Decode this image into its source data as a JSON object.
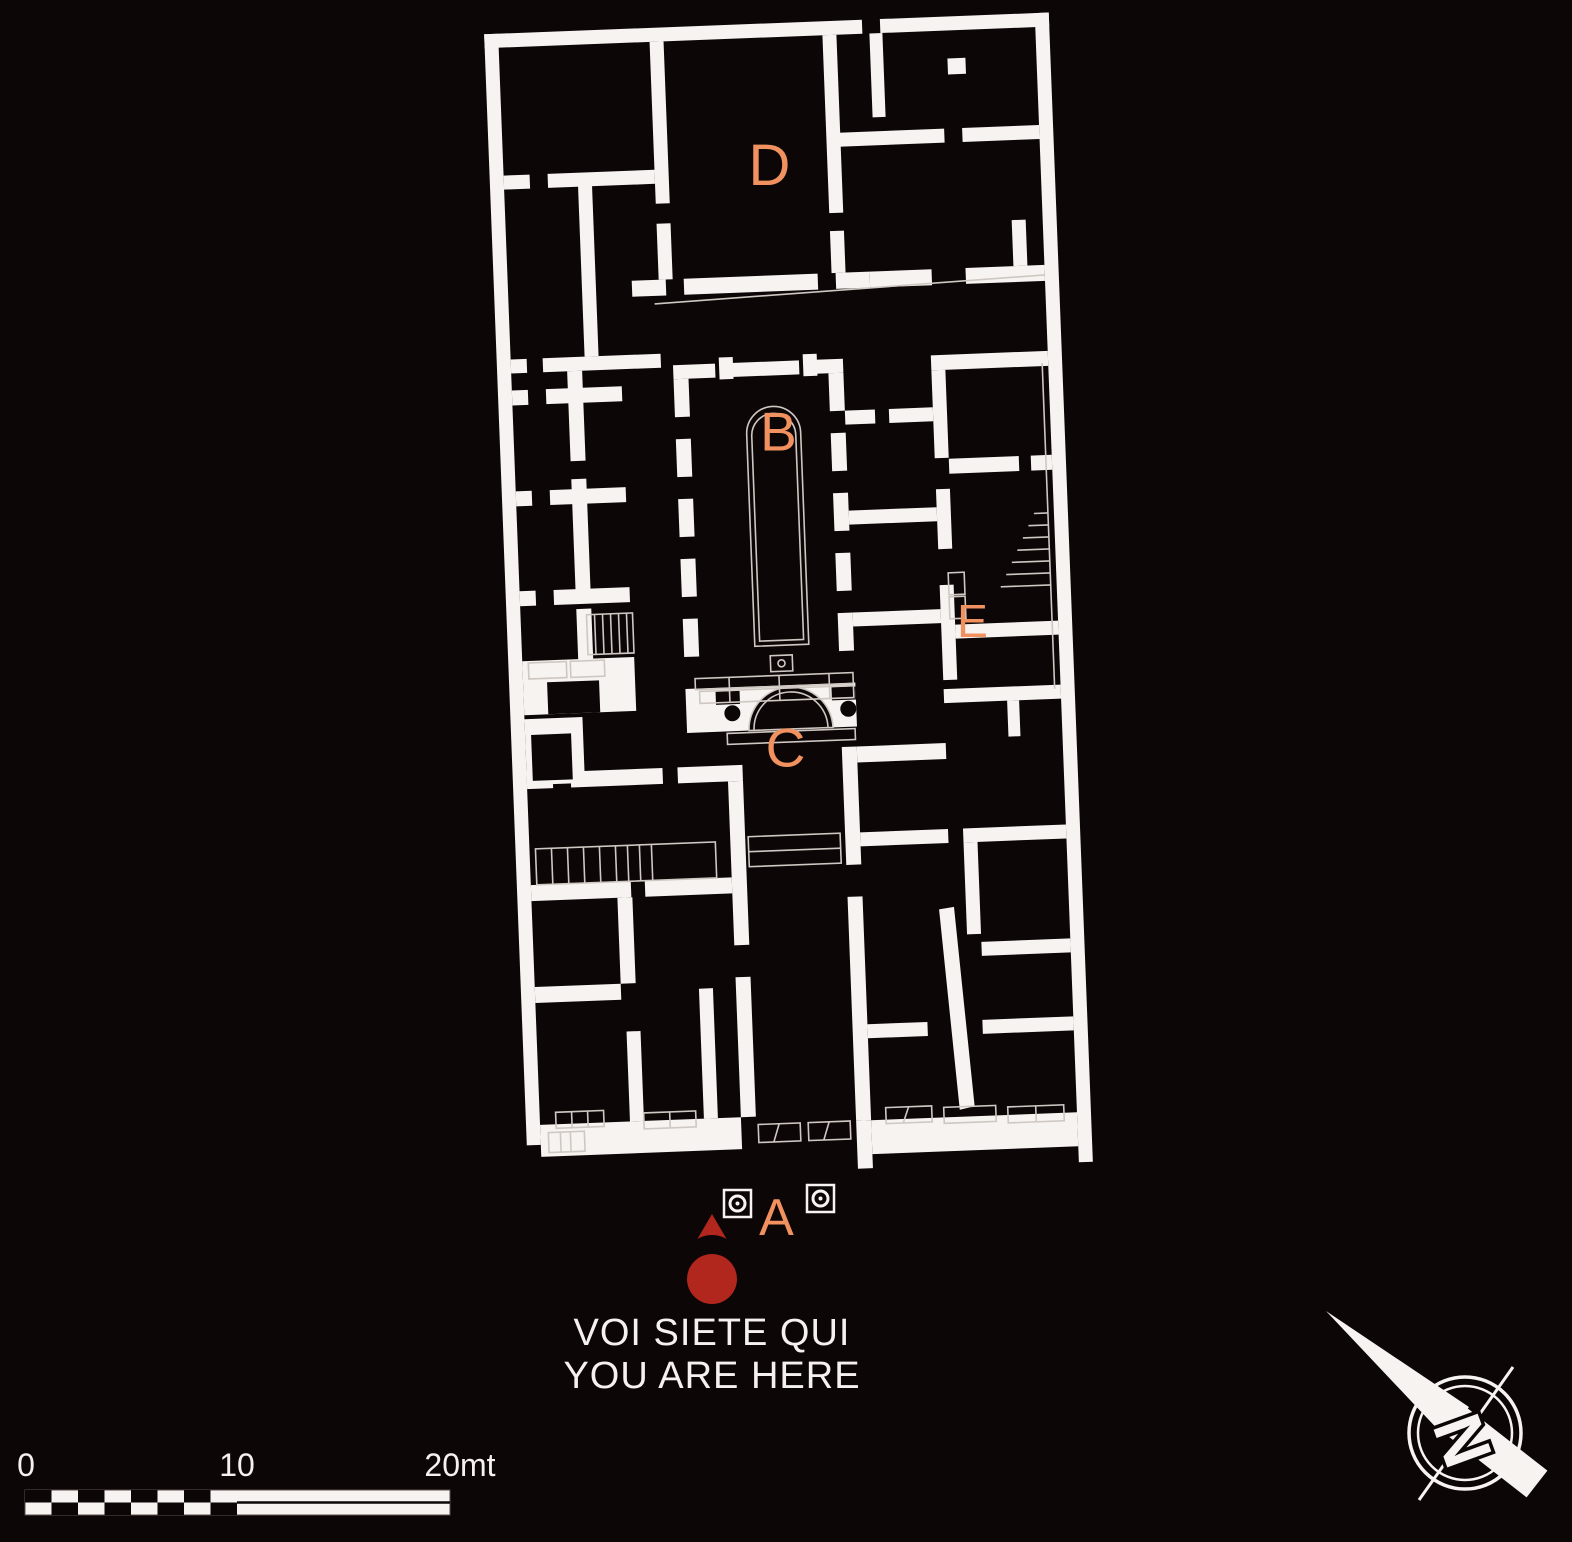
{
  "map": {
    "title": "archaeological floor plan",
    "labels": {
      "a": "A",
      "b": "B",
      "c": "C",
      "d": "D",
      "e": "E"
    },
    "label_color": "#f0915f"
  },
  "you_are_here": {
    "line1": "VOI SIETE QUI",
    "line2": "YOU ARE HERE",
    "marker_color": "#b1261d",
    "text_color": "#f4f1ee"
  },
  "scale_bar": {
    "zero": "0",
    "ten": "10",
    "twenty": "20mt"
  },
  "compass": {
    "north": "N"
  },
  "colors": {
    "background": "#0d0607",
    "walls": "#f6f3f0",
    "detail_lines": "#cfc7c1"
  }
}
